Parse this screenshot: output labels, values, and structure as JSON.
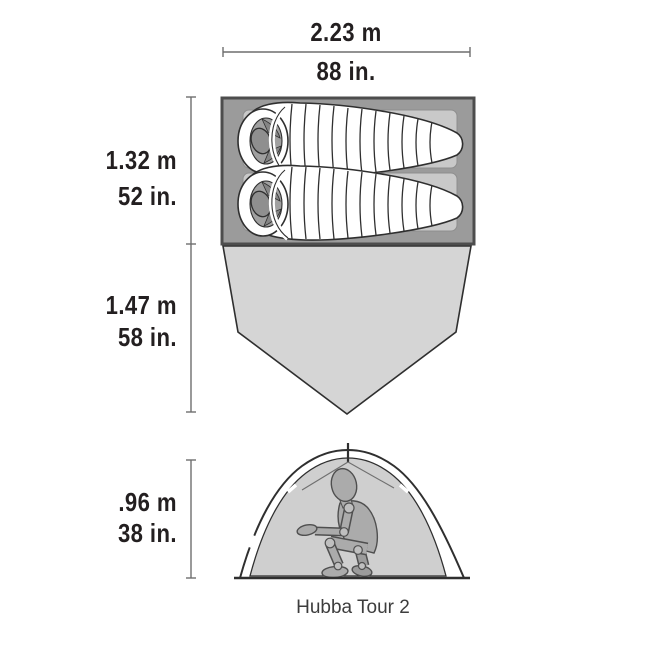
{
  "product": {
    "name": "Hubba Tour 2"
  },
  "dimensions": {
    "width": {
      "metric": "2.23 m",
      "imperial": "88 in."
    },
    "interior_length": {
      "metric": "1.32 m",
      "imperial": "52 in."
    },
    "vestibule_length": {
      "metric": "1.47 m",
      "imperial": "58 in."
    },
    "peak_height": {
      "metric": ".96 m",
      "imperial": "38 in."
    }
  },
  "views": {
    "top_view": "tent floor plan with two sleeping bags and vestibule",
    "side_view": "tent profile with crouching person"
  },
  "palette": {
    "floor_gray": "#9b9b9b",
    "floor_border": "#4d4d4d",
    "vestibule_gray": "#d5d5d5",
    "pad_gray": "#c9c9c9",
    "canopy_gray": "#cfcfcf",
    "figure_gray": "#ababab",
    "outline_dark": "#2f2f2f",
    "dimension_line_gray": "#6e6e6e",
    "text_black": "#231f20"
  }
}
